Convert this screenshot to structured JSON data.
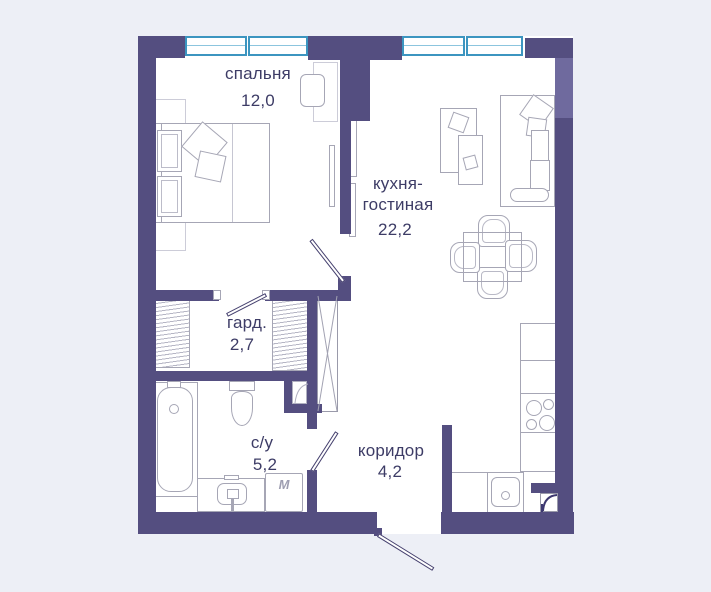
{
  "plan_title": "apartment-floor-plan",
  "colors": {
    "background": "#edeff6",
    "floor": "#ffffff",
    "wall": "#544e80",
    "wall_light": "#6f6a9e",
    "window_frame": "#3c95c0",
    "label_text": "#3d3c66",
    "furniture_outline": "#a6a6b5"
  },
  "rooms": [
    {
      "id": "bedroom",
      "label": "спальня",
      "area": "12,0"
    },
    {
      "id": "kitchen_living",
      "label_lines": [
        "кухня-",
        "гостиная"
      ],
      "area": "22,2"
    },
    {
      "id": "wardrobe",
      "label": "гард.",
      "area": "2,7"
    },
    {
      "id": "bathroom",
      "label": "с/у",
      "area": "5,2"
    },
    {
      "id": "corridor",
      "label": "коридор",
      "area": "4,2"
    }
  ],
  "appliances": {
    "washer_symbol": "M"
  }
}
